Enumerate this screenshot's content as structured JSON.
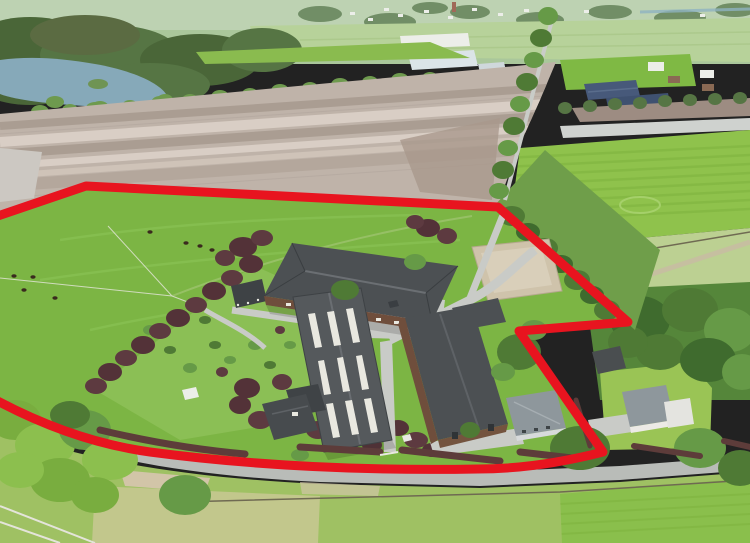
{
  "image": {
    "kind": "aerial-drone-photograph",
    "subject": "rural equestrian property with stables, barns, houses, gardens, pastures and farmland",
    "annotation": "red outline marking the property boundary"
  },
  "boundary": {
    "color": "#e8141f",
    "stroke_width": 9,
    "path": "M -8 218 L 86 186 L 498 207 L 628 322 L 519 331 L 603 452 C 560 463 520 469 478 469 C 370 471 255 466 150 452 C 92 444 40 424 -8 398 Z"
  },
  "palette": {
    "plowed_field": "#bfb3a9",
    "pasture_green": "#7cb544",
    "crop_field_green": "#8fc24c",
    "road_grey": "#b9bcb8",
    "sand_arena": "#cfc3ab",
    "water": "#86a9b9",
    "dark_roof": "#4c5053",
    "copper_beech": "#533238",
    "tree_green": "#4f7a35",
    "haze_green": "#aac79b"
  },
  "elements": [
    "village-skyline",
    "forest",
    "lake",
    "greenhouses",
    "solar-roof-barns",
    "ploughed-field",
    "green-crop-field",
    "rough-pasture",
    "tree-lined-lane",
    "property-pasture",
    "horses",
    "copper-beech-trees",
    "garden-lawn",
    "field-shelter",
    "main-stable",
    "skylight-barn",
    "south-stable",
    "horse-walker",
    "sand-paddock",
    "driveways",
    "main-house",
    "guest-house",
    "neighbour-house",
    "garden-shed",
    "access-road",
    "roadside-hedges",
    "bottom-paddocks",
    "red-boundary-outline"
  ]
}
